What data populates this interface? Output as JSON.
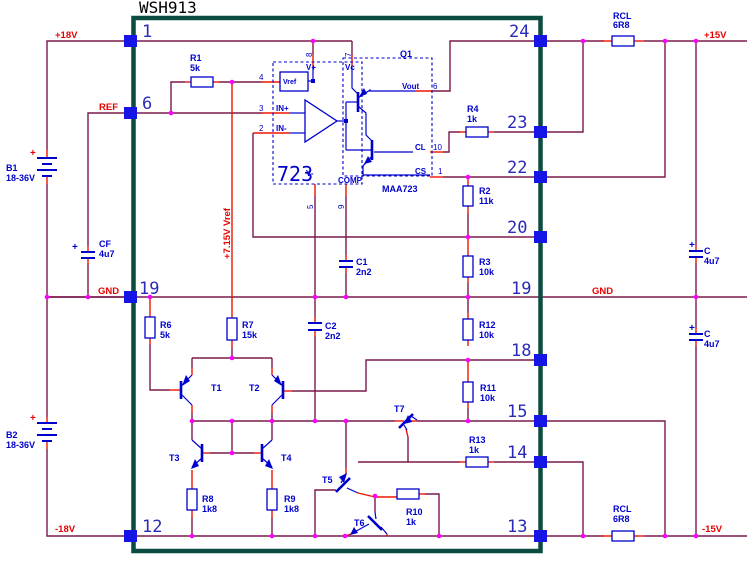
{
  "title": "WSH913",
  "colors": {
    "wire": "#7a1a4a",
    "stub": "#ee1500",
    "pin": "#1515e6",
    "junction": "#ff00ff",
    "border": "#0a4c40",
    "sym": "#0000cd",
    "numcol": "#2a2ab8",
    "nettext": "#e80000"
  },
  "pins": {
    "left": [
      "1",
      "6",
      "19",
      "12"
    ],
    "right": [
      "24",
      "23",
      "22",
      "20",
      "19",
      "18",
      "15",
      "14",
      "13"
    ]
  },
  "nets": {
    "p18": "+18V",
    "ref": "REF",
    "gnd_left": "GND",
    "n18": "-18V",
    "p15": "+15V",
    "gnd_right": "GND",
    "n15": "-15V",
    "vref_rail": "+7.15V Vref"
  },
  "batteries": {
    "plus": "+",
    "b1": {
      "ref": "B1",
      "value": "18-36V"
    },
    "b2": {
      "ref": "B2",
      "value": "18-36V"
    }
  },
  "resistors": {
    "r1": {
      "ref": "R1",
      "value": "5k"
    },
    "r2": {
      "ref": "R2",
      "value": "11k"
    },
    "r3": {
      "ref": "R3",
      "value": "10k"
    },
    "r4": {
      "ref": "R4",
      "value": "1k"
    },
    "r6": {
      "ref": "R6",
      "value": "5k"
    },
    "r7": {
      "ref": "R7",
      "value": "15k"
    },
    "r8": {
      "ref": "R8",
      "value": "1k8"
    },
    "r9": {
      "ref": "R9",
      "value": "1k8"
    },
    "r10": {
      "ref": "R10",
      "value": "1k"
    },
    "r11": {
      "ref": "R11",
      "value": "10k"
    },
    "r12": {
      "ref": "R12",
      "value": "10k"
    },
    "r13": {
      "ref": "R13",
      "value": "1k"
    },
    "rcl_top": {
      "ref": "RCL",
      "value": "6R8"
    },
    "rcl_bot": {
      "ref": "RCL",
      "value": "6R8"
    }
  },
  "capacitors": {
    "plus": "+",
    "c1": {
      "ref": "C1",
      "value": "2n2"
    },
    "c2": {
      "ref": "C2",
      "value": "2n2"
    },
    "cf": {
      "ref": "CF",
      "value": "4u7"
    },
    "c_top": {
      "ref": "C",
      "value": "4u7"
    },
    "c_bot": {
      "ref": "C",
      "value": "4u7"
    }
  },
  "transistors": {
    "t1": "T1",
    "t2": "T2",
    "t3": "T3",
    "t4": "T4",
    "t5": "T5",
    "t6": "T6",
    "t7": "T7"
  },
  "ic": {
    "name": "723",
    "part": "MAA723",
    "q": "Q1",
    "labels": {
      "vref": "Vref",
      "vplus": "V+",
      "vc": "Vc",
      "inp": "IN+",
      "inn": "IN-",
      "vminus": "V-",
      "comp": "COMP",
      "vout": "Vout",
      "cl": "CL",
      "cs": "CS"
    },
    "pin_nums": {
      "p8": "8",
      "p7": "7",
      "p4": "4",
      "p3": "3",
      "p2": "2",
      "p5": "5",
      "p9": "9",
      "p6": "6",
      "p10": "10",
      "p1": "1"
    }
  }
}
